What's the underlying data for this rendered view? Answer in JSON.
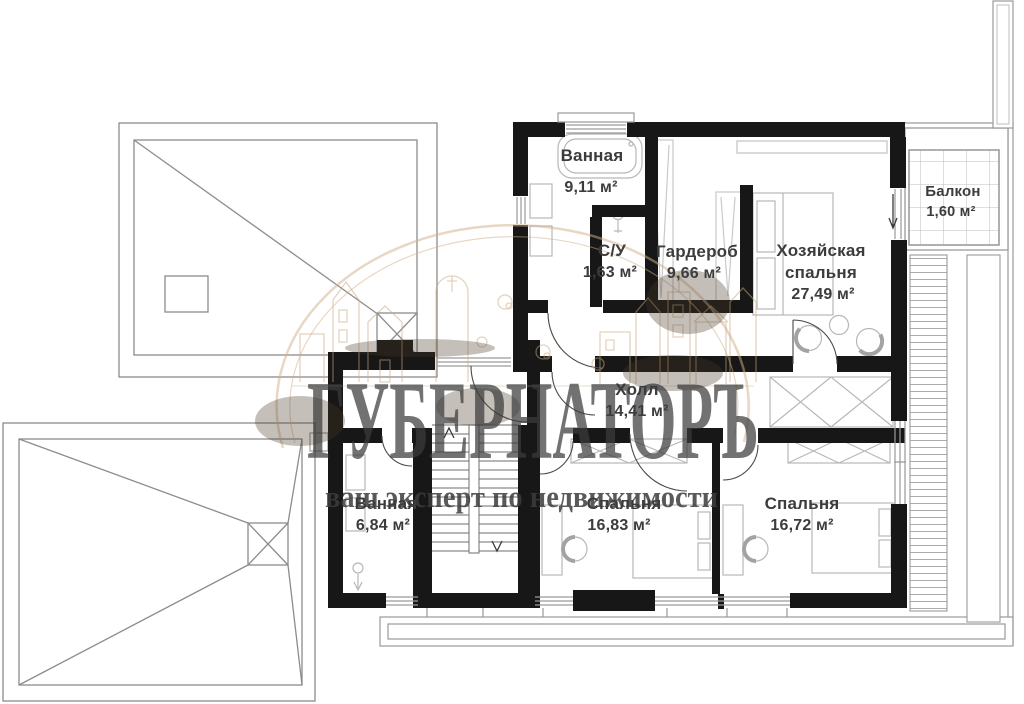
{
  "floor_plan": {
    "rooms": [
      {
        "id": "bathroom-upper",
        "name": "Ванная",
        "area": "9,11 м²"
      },
      {
        "id": "wc",
        "name": "С/У",
        "area": "1,63 м²"
      },
      {
        "id": "wardrobe",
        "name": "Гардероб",
        "area": "9,66 м²"
      },
      {
        "id": "master-bedroom",
        "name": "Хозяйская спальня",
        "name_line1": "Хозяйская",
        "name_line2": "спальня",
        "area": "27,49 м²"
      },
      {
        "id": "balcony",
        "name": "Балкон",
        "area": "1,60 м²"
      },
      {
        "id": "hall",
        "name": "Холл",
        "area": "14,41 м²"
      },
      {
        "id": "bathroom-lower",
        "name": "Ванная",
        "area": "6,84 м²"
      },
      {
        "id": "bedroom-1",
        "name": "Спальня",
        "area": "16,83 м²"
      },
      {
        "id": "bedroom-2",
        "name": "Спальня",
        "area": "16,72 м²"
      }
    ],
    "watermark": {
      "title": "ГУБЕРНАТОРЪ",
      "subtitle": "ваш эксперт по недвижимости",
      "color": "#d9bf9d"
    },
    "colors": {
      "wall": "#171717",
      "outline": "#9a9a9a",
      "furniture": "#b7b7b7",
      "label": "#3c3c3c"
    }
  }
}
